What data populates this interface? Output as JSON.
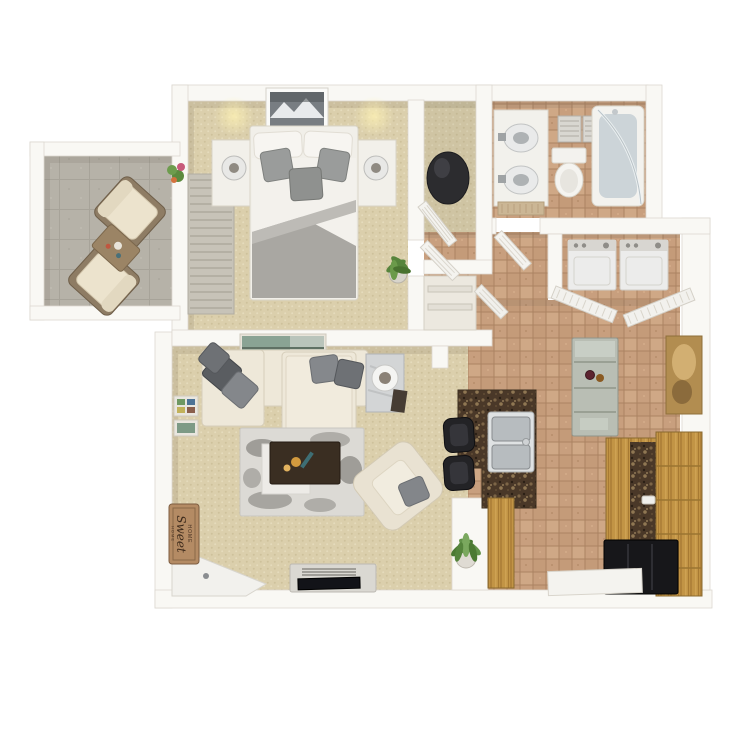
{
  "floorplan": {
    "description": "3D top-down rendered floor plan of a one-bedroom, one-bathroom apartment with patio",
    "background": "#ffffff",
    "sign": {
      "line1": "HOME",
      "line2": "Sweet",
      "line3": "HOME"
    },
    "palette": {
      "wall": "#f9f8f4",
      "wall_edge": "#dcd8d0",
      "carpet": "#dbcfac",
      "tile": "#c89f7e",
      "concrete": "#b6b2a8",
      "granite": "#4a3828",
      "wood": "#c29445",
      "appliance_black": "#17171a",
      "sofa_cream": "#eee8d9",
      "pillow_gray": "#84878b",
      "rug_gray": "#dcdad5",
      "coffee_table_brown": "#3a2e22",
      "bedding_white": "#f3f1ec",
      "blanket_gray": "#a9a7a2",
      "mat_tan": "#b48b64"
    },
    "rooms": [
      {
        "name": "Patio",
        "floor": "concrete",
        "furniture": [
          "patio lounge chair",
          "patio lounge chair",
          "wood side table",
          "flower pot"
        ]
      },
      {
        "name": "Bedroom",
        "floor": "carpet",
        "furniture": [
          "queen bed with gray throw pillows",
          "nightstand with lamp",
          "nightstand with lamp",
          "framed mountain art",
          "vertical blinds / patio door",
          "potted plant"
        ]
      },
      {
        "name": "Walk-in Closet",
        "floor": "carpet",
        "furniture": [
          "bean bag chair",
          "louvered door"
        ]
      },
      {
        "name": "Bathroom",
        "floor": "tile",
        "furniture": [
          "double-sink vanity",
          "toilet",
          "tub shower with curved glass door",
          "ceiling vent",
          "bath mat"
        ]
      },
      {
        "name": "Hallway",
        "floor": "tile",
        "furniture": [
          "linen closet with shelves",
          "open interior doors"
        ]
      },
      {
        "name": "Laundry Closet",
        "floor": "tile",
        "furniture": [
          "washer",
          "dryer",
          "bi-fold louvered doors"
        ]
      },
      {
        "name": "Kitchen / Dining",
        "floor": "tile",
        "furniture": [
          "granite breakfast bar",
          "stainless double-basin sink",
          "bar stool",
          "bar stool",
          "serving cart with wine bottles",
          "wood base cabinets",
          "granite countertop",
          "tall wood pantry",
          "black base cabinet",
          "gold abstract wall art",
          "white floor mat"
        ]
      },
      {
        "name": "Living Room",
        "floor": "carpet",
        "furniture": [
          "sectional sofa with chaise",
          "gray throw pillows",
          "marble side table with sphere lamp",
          "distressed area rug",
          "dark wood coffee table",
          "cream accent chair",
          "TV console with flat TV",
          "white corner desk",
          "gallery picture frames",
          "HOME Sweet HOME mat",
          "potted plant",
          "landscape wall art"
        ]
      }
    ]
  }
}
